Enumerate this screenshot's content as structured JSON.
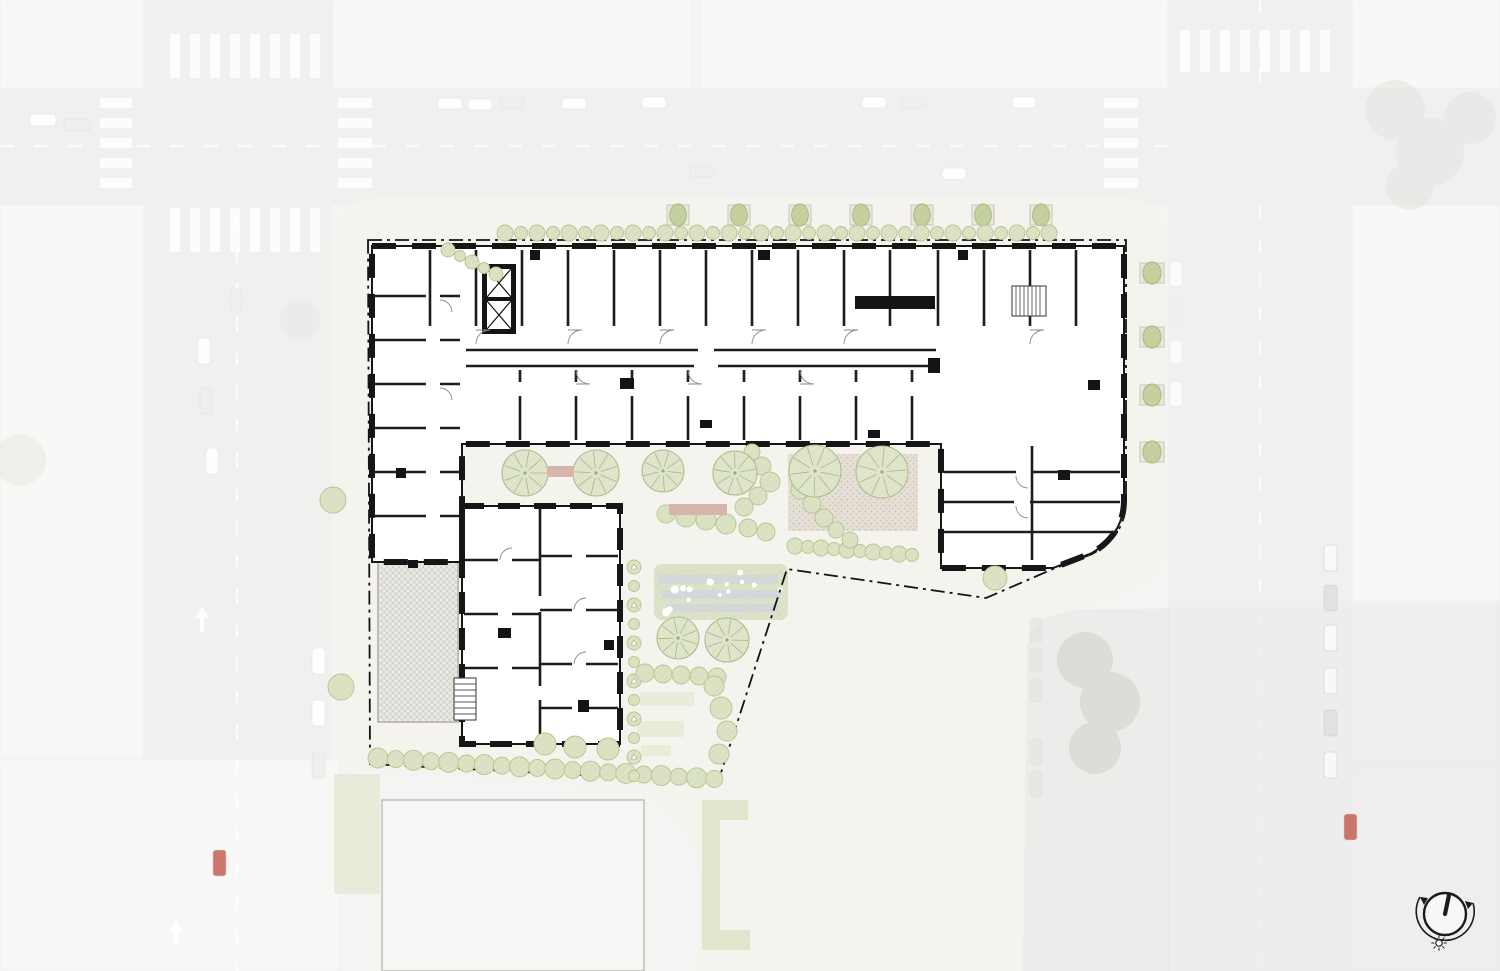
{
  "palette": {
    "aerial_base": "#eae9e7",
    "street": "#e1e0dd",
    "block": "#f2f1ee",
    "block_line": "#e0ded9",
    "road_mark": "#ffffff",
    "site": "#f5f3ee",
    "plan": "#ffffff",
    "wall": "#161616",
    "partition": "#1d1d1d",
    "thin": "#8a8a8a",
    "boundary": "#131313",
    "tree_fill": "#e2e7cf",
    "tree_line": "#adba8c",
    "shrub_fill": "#dde4c7",
    "shrub_line": "#b7c38f",
    "street_tree": "#c5d09e",
    "street_tree_line": "#a4b47c",
    "planter": "#e9e9df",
    "planter_line": "#c6c6b8",
    "lawn": "#e7ebd6",
    "garden": "#dfe5cd",
    "garden_gray": "#d4d6da",
    "plaza": "#e5dfd6",
    "plaza_dot": "#c8c1b5",
    "bench": "#d8b5ab",
    "terrace_line": "#c9c6c0",
    "parcel": "#e9eaea",
    "parcel_line": "#90938f",
    "roof_a": "#aeb8c3",
    "roof_b": "#9aa7b7",
    "veil": "#ffffff",
    "compass": "#1b1b1b",
    "car_red": "#c4574d",
    "car_white": "#fdfdfd",
    "car_gray": "#dcdcdc"
  },
  "aerial": {
    "veil_opacity": 0.52,
    "cars_under": [
      [
        438,
        98,
        24,
        11,
        "white",
        1
      ],
      [
        468,
        99,
        24,
        11,
        "white",
        1
      ],
      [
        500,
        98,
        24,
        11,
        "gray",
        1
      ],
      [
        562,
        98,
        24,
        11,
        "white",
        1
      ],
      [
        642,
        97,
        24,
        11,
        "white",
        1
      ],
      [
        862,
        97,
        24,
        11,
        "white",
        1
      ],
      [
        902,
        98,
        24,
        11,
        "gray",
        1
      ],
      [
        1012,
        97,
        24,
        11,
        "white",
        1
      ],
      [
        690,
        166,
        24,
        11,
        "gray",
        1
      ],
      [
        942,
        168,
        24,
        11,
        "white",
        1
      ],
      [
        30,
        114,
        26,
        12,
        "white",
        1
      ],
      [
        64,
        119,
        26,
        12,
        "gray",
        1
      ],
      [
        198,
        338,
        12,
        26,
        "white",
        1
      ],
      [
        200,
        388,
        12,
        26,
        "gray",
        1
      ],
      [
        206,
        448,
        12,
        26,
        "white",
        1
      ],
      [
        230,
        288,
        12,
        24,
        "gray",
        1
      ],
      [
        312,
        648,
        13,
        26,
        "white",
        1
      ],
      [
        312,
        700,
        13,
        26,
        "white",
        1
      ],
      [
        312,
        752,
        13,
        26,
        "gray",
        1
      ],
      [
        1170,
        262,
        12,
        24,
        "white",
        0.7
      ],
      [
        1170,
        300,
        12,
        24,
        "gray",
        0.7
      ],
      [
        1170,
        340,
        12,
        24,
        "white",
        0.7
      ],
      [
        1170,
        382,
        12,
        24,
        "white",
        0.7
      ]
    ],
    "cars_over": [
      [
        213,
        850,
        13,
        26,
        "red",
        0.8
      ],
      [
        1324,
        545,
        13,
        26,
        "white",
        0.75
      ],
      [
        1324,
        585,
        13,
        26,
        "gray",
        0.7
      ],
      [
        1324,
        625,
        13,
        26,
        "white",
        0.75
      ],
      [
        1324,
        668,
        13,
        26,
        "white",
        0.7
      ],
      [
        1324,
        710,
        13,
        26,
        "gray",
        0.7
      ],
      [
        1324,
        752,
        13,
        26,
        "white",
        0.7
      ],
      [
        1344,
        814,
        13,
        26,
        "red",
        0.8
      ],
      [
        1030,
        618,
        12,
        24,
        "gray",
        0.35
      ],
      [
        1030,
        648,
        12,
        24,
        "gray",
        0.35
      ],
      [
        1030,
        678,
        12,
        24,
        "gray",
        0.3
      ],
      [
        1030,
        740,
        12,
        24,
        "gray",
        0.3
      ],
      [
        1030,
        772,
        12,
        24,
        "gray",
        0.3
      ]
    ],
    "crosswalks": [
      {
        "x": 170,
        "y": 34,
        "dx": 20,
        "dy": 0,
        "n": 8,
        "w": 10,
        "h": 44
      },
      {
        "x": 170,
        "y": 208,
        "dx": 20,
        "dy": 0,
        "n": 8,
        "w": 10,
        "h": 44
      },
      {
        "x": 338,
        "y": 98,
        "dx": 0,
        "dy": 20,
        "n": 5,
        "w": 34,
        "h": 10
      },
      {
        "x": 100,
        "y": 98,
        "dx": 0,
        "dy": 20,
        "n": 5,
        "w": 32,
        "h": 10
      },
      {
        "x": 1104,
        "y": 98,
        "dx": 0,
        "dy": 20,
        "n": 5,
        "w": 34,
        "h": 10
      },
      {
        "x": 1180,
        "y": 30,
        "dx": 20,
        "dy": 0,
        "n": 8,
        "w": 10,
        "h": 42
      }
    ]
  },
  "landscape": {
    "street_trees_top": [
      [
        678,
        215
      ],
      [
        739,
        215
      ],
      [
        800,
        215
      ],
      [
        861,
        215
      ],
      [
        922,
        215
      ],
      [
        983,
        215
      ],
      [
        1041,
        215
      ]
    ],
    "street_trees_right": [
      [
        1152,
        273
      ],
      [
        1152,
        337
      ],
      [
        1152,
        395
      ],
      [
        1152,
        452
      ]
    ],
    "street_trees_left": [
      [
        333,
        500
      ],
      [
        341,
        687
      ]
    ],
    "corner_tree": [
      995,
      578
    ],
    "canopy_trees": [
      [
        525,
        473,
        23
      ],
      [
        596,
        473,
        23
      ],
      [
        663,
        471,
        21
      ],
      [
        735,
        473,
        22
      ],
      [
        815,
        471,
        26
      ],
      [
        882,
        472,
        26
      ],
      [
        678,
        638,
        21
      ],
      [
        727,
        640,
        22
      ]
    ],
    "shrubs": [
      [
        752,
        452,
        8
      ],
      [
        762,
        466,
        9
      ],
      [
        770,
        482,
        10
      ],
      [
        758,
        496,
        9
      ],
      [
        744,
        507,
        9
      ],
      [
        666,
        514,
        9
      ],
      [
        686,
        517,
        10
      ],
      [
        706,
        520,
        10
      ],
      [
        726,
        524,
        10
      ],
      [
        748,
        528,
        9
      ],
      [
        766,
        532,
        9
      ],
      [
        800,
        490,
        9
      ],
      [
        812,
        504,
        9
      ],
      [
        824,
        518,
        9
      ],
      [
        836,
        530,
        8
      ],
      [
        850,
        540,
        8
      ],
      [
        545,
        744,
        11
      ],
      [
        575,
        747,
        11
      ],
      [
        608,
        749,
        11
      ]
    ],
    "shrub_row_plaza": {
      "x0": 795,
      "y0": 546,
      "n": 10,
      "dx": 13,
      "dy": 1,
      "r": 8
    },
    "hedge_top": {
      "x0": 505,
      "y0": 233,
      "n": 35,
      "dx": 16,
      "dy": 0,
      "r": 8
    },
    "hedge_slope": {
      "x0": 448,
      "y0": 250,
      "n": 5,
      "dx": 12,
      "dy": 6,
      "r": 7
    },
    "hedge_bottom": {
      "x0": 378,
      "y0": 758,
      "n": 20,
      "dx": 17.7,
      "dy": 1.1,
      "r": 10
    },
    "hedge_col": {
      "x0": 634,
      "y0": 567,
      "n": 12,
      "dx": 0,
      "dy": 19,
      "r": 7
    },
    "path_trees": [
      [
        714,
        686,
        10
      ],
      [
        721,
        708,
        11
      ],
      [
        727,
        731,
        10
      ],
      [
        719,
        754,
        10
      ]
    ],
    "shrub_row_mid": [
      [
        645,
        673,
        9
      ],
      [
        663,
        674,
        9
      ],
      [
        681,
        675,
        9
      ],
      [
        699,
        676,
        9
      ],
      [
        717,
        677,
        9
      ]
    ],
    "lawn_strips": [
      [
        640,
        692,
        54,
        14
      ],
      [
        637,
        721,
        47,
        16
      ],
      [
        641,
        745,
        30,
        11
      ],
      [
        368,
        430,
        13,
        24
      ],
      [
        368,
        459,
        13,
        20
      ]
    ],
    "benches": [
      [
        547,
        466,
        26,
        11
      ],
      [
        669,
        504,
        58,
        11
      ]
    ],
    "plaza": {
      "x": 788,
      "y": 454,
      "w": 130,
      "h": 77
    },
    "garden": {
      "x": 654,
      "y": 564,
      "w": 134,
      "h": 56
    },
    "green_c": {
      "x": 702,
      "y": 800,
      "w": 46,
      "h": 150,
      "t": 20
    }
  },
  "compass": {
    "cx": 1445,
    "cy": 914,
    "r": 21,
    "arc_r": 29,
    "needle_dx": 4,
    "needle_dy": -19,
    "sun": [
      1439,
      943
    ],
    "sun_r": 3.2
  }
}
